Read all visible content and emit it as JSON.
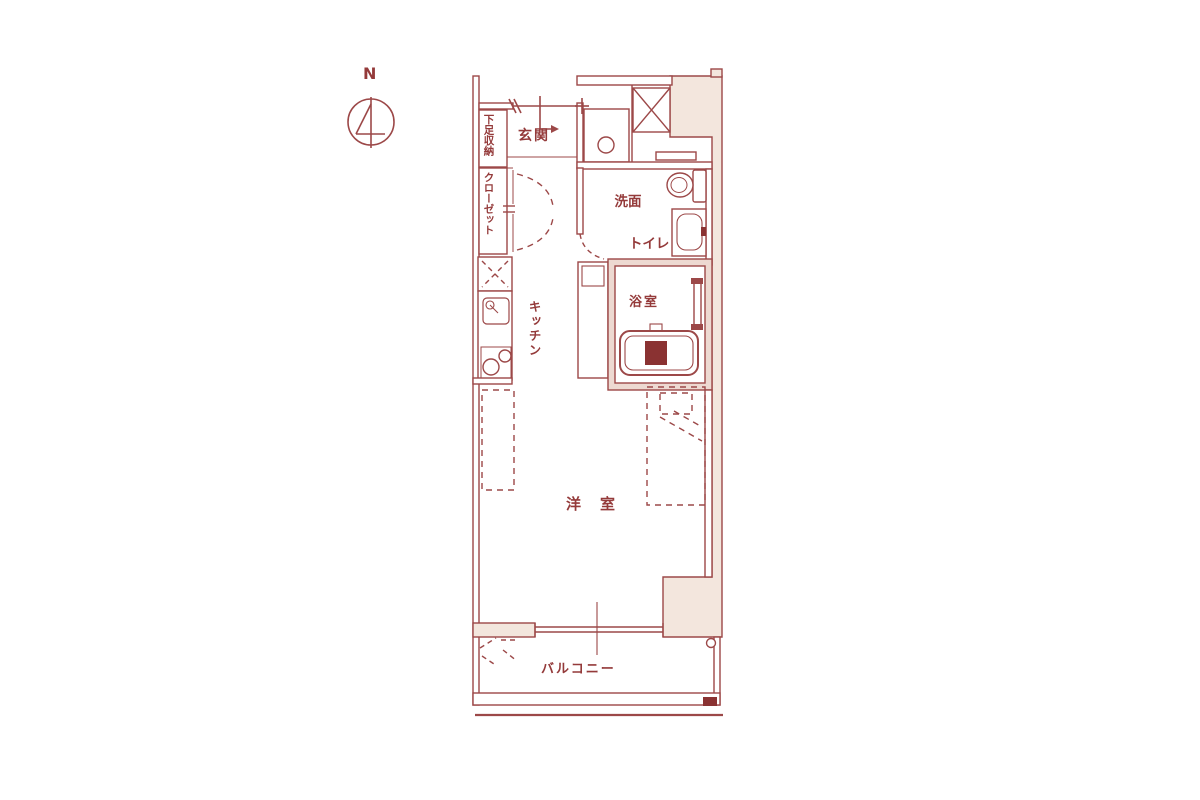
{
  "meta": {
    "type": "japanese-apartment-floor-plan",
    "compass_label": "N"
  },
  "palette": {
    "line": "#9c4848",
    "line_dark": "#8a3232",
    "text": "#943a3a",
    "outside_fill": "#f3e6dd",
    "bath_wall_fill": "#edd9d1",
    "background": "#ffffff"
  },
  "labels": {
    "shoe_storage": "下足収納",
    "entrance": "玄関",
    "closet": "クローゼット",
    "washroom_line1": "洗面",
    "washroom_line2": "トイレ",
    "kitchen": "キッチン",
    "bathroom": "浴室",
    "main_room": "洋　室",
    "balcony": "バルコニー"
  },
  "fixtures": [
    "pipe-shaft-x-box",
    "washing-machine-pan",
    "toilet",
    "vanity-basin",
    "refrigerator-space",
    "kitchen-sink",
    "stove-two-burners",
    "bathtub",
    "bed-dashed-outline",
    "counter-dashed-outline",
    "balcony-drain",
    "evacuation-hatch-dashed",
    "entry-door-swing",
    "closet-folding-doors"
  ]
}
